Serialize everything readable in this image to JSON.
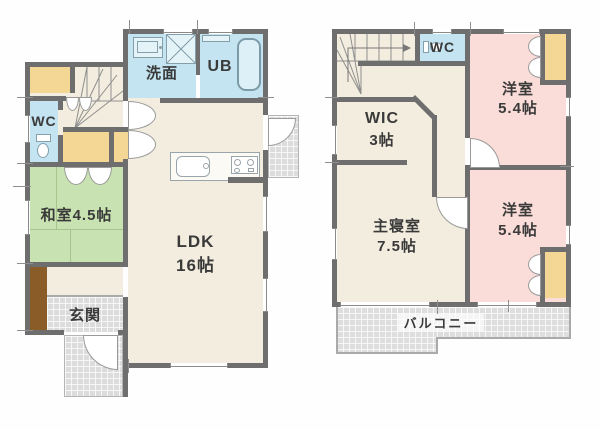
{
  "title": "2-story house floor plan",
  "colors": {
    "wall": "#6e6e6e",
    "wood_floor": "#f2edde",
    "water_rooms_blue": "#c3e4f0",
    "tatami_green": "#c8e3b1",
    "closet_orange": "#f5d795",
    "bedroom_pink": "#fadcd8",
    "cabinet_brown": "#8a5c28",
    "outline": "#9a9a9a",
    "text": "#3a3a3a"
  },
  "f1": {
    "senmen": "洗面",
    "ub": "UB",
    "wc": "WC",
    "washitsu": "和室4.5帖",
    "ldk1": "LDK",
    "ldk2": "16帖",
    "genkan": "玄関"
  },
  "f2": {
    "wc": "WC",
    "yo1a": "洋室",
    "yo1b": "5.4帖",
    "wica": "WIC",
    "wicb": "3帖",
    "shua": "主寝室",
    "shub": "7.5帖",
    "yo2a": "洋室",
    "yo2b": "5.4帖",
    "balcony": "バルコニー"
  }
}
